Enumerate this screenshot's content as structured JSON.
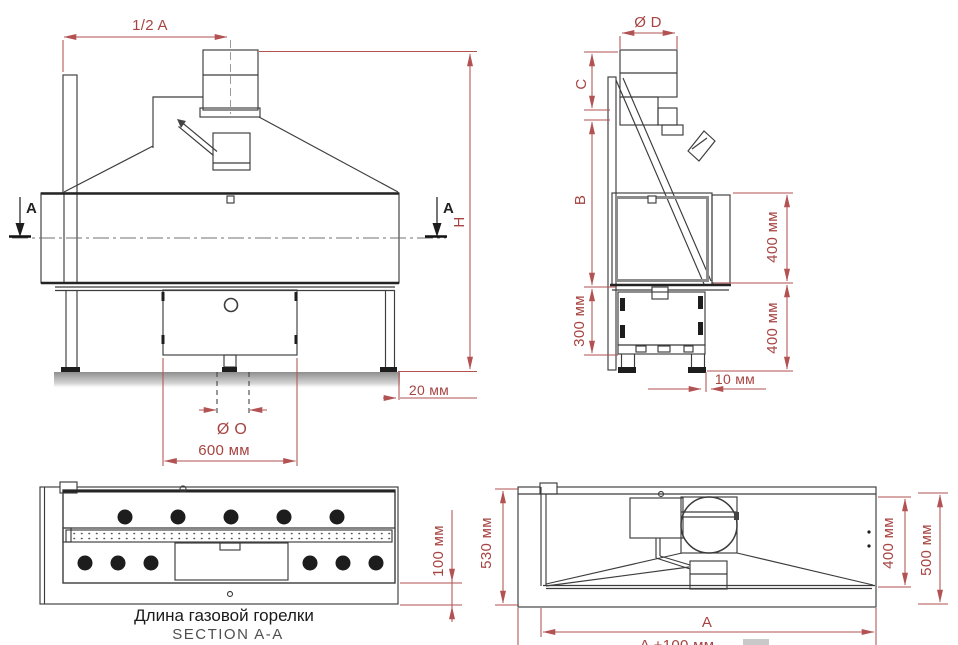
{
  "colors": {
    "dimension_red": "#a64442",
    "line_dark": "#3c3c3c",
    "caption_black": "#1a1a1a",
    "caption_gray": "#4f4f4f"
  },
  "views": {
    "front": {
      "dim_half_a": "1/2 A",
      "dim_h": "H",
      "section_label_left": "A",
      "section_label_right": "A",
      "dim_20mm": "20 мм",
      "dim_dia_o": "Ø O",
      "dim_600mm": "600 мм"
    },
    "side": {
      "dim_dia_d": "Ø D",
      "dim_c": "C",
      "dim_b": "B",
      "dim_300mm": "300 мм",
      "dim_400mm_upper": "400 мм",
      "dim_400mm_lower": "400 мм",
      "dim_10mm": "10 мм"
    },
    "section": {
      "dim_100mm": "100 мм",
      "caption_line1": "Длина газовой горелки",
      "caption_line2": "SECTION A-A"
    },
    "plan": {
      "dim_530mm": "530 мм",
      "dim_400mm": "400 мм",
      "dim_500mm": "500 мм",
      "dim_a": "A",
      "dim_a_plus_100": "A +100 мм"
    }
  }
}
